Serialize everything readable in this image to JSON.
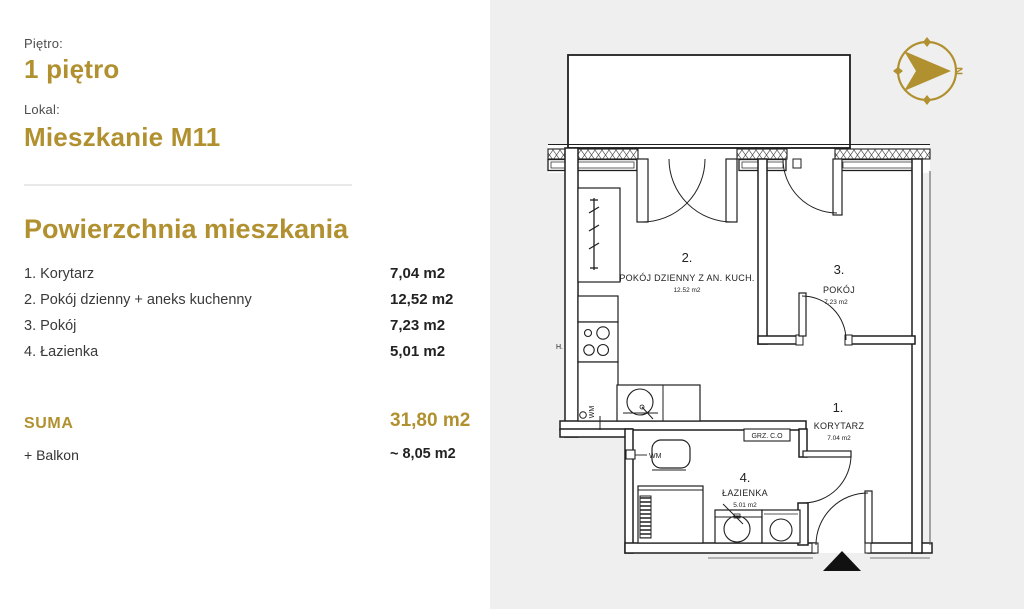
{
  "colors": {
    "gold": "#b1902f",
    "panel_bg": "#ffffff",
    "plan_bg": "#efefef",
    "line": "#1f1f1f",
    "divider": "#e9e9e9"
  },
  "header": {
    "floor_label": "Piętro:",
    "floor_value": "1 piętro",
    "unit_label": "Lokal:",
    "unit_value": "Mieszkanie M11"
  },
  "areas": {
    "title": "Powierzchnia mieszkania",
    "rows": [
      {
        "label": "1. Korytarz",
        "value": "7,04 m2"
      },
      {
        "label": "2. Pokój dzienny + aneks kuchenny",
        "value": "12,52 m2"
      },
      {
        "label": "3. Pokój",
        "value": "7,23 m2"
      },
      {
        "label": "4. Łazienka",
        "value": "5,01 m2"
      }
    ],
    "total_label": "SUMA",
    "total_value": "31,80 m2",
    "balcony_label": "+ Balkon",
    "balcony_value": "~ 8,05 m2"
  },
  "plan": {
    "rooms": [
      {
        "no": "1.",
        "name": "KORYTARZ",
        "area": "7.04 m2"
      },
      {
        "no": "2.",
        "name": "POKÓJ DZIENNY Z AN. KUCH.",
        "area": "12.52 m2"
      },
      {
        "no": "3.",
        "name": "POKÓJ",
        "area": "7.23 m2"
      },
      {
        "no": "4.",
        "name": "ŁAZIENKA",
        "area": "5.01 m2"
      }
    ],
    "annotations": {
      "radiator_box": "GRZ. C.O",
      "washer_kitchen": "WM",
      "washer_bath": "WM",
      "hood": "H.",
      "compass_north": "N"
    }
  }
}
